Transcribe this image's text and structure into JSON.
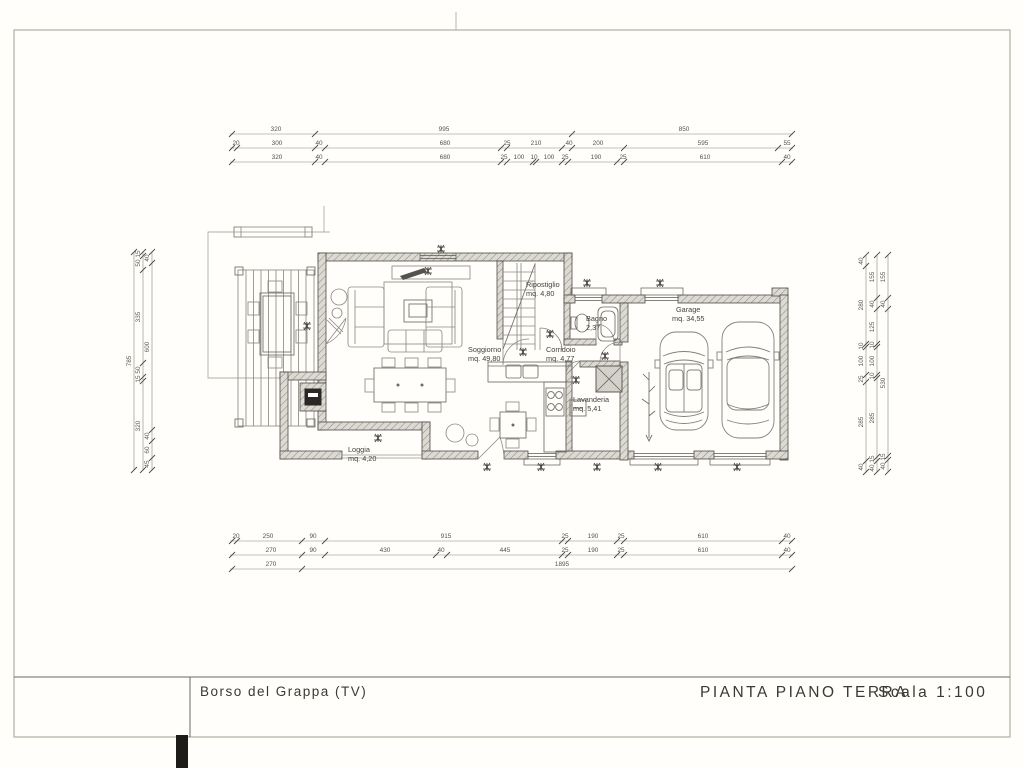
{
  "title_block": {
    "location": "Borso del Grappa (TV)",
    "drawing_title": "PIANTA PIANO TERRA",
    "scale": "Scala 1:100"
  },
  "rooms": [
    {
      "name": "Soggiorno",
      "area": "mq. 49,80"
    },
    {
      "name": "Ripostiglio",
      "area": "mq. 4,80"
    },
    {
      "name": "Bagno",
      "area": "2,37"
    },
    {
      "name": "Corridoio",
      "area": "mq. 4,77"
    },
    {
      "name": "Lavanderia",
      "area": "mq. 5,41"
    },
    {
      "name": "Garage",
      "area": "mq. 34,55"
    },
    {
      "name": "Loggia",
      "area": "mq. 4,20"
    }
  ],
  "dimensions": {
    "top_row1": [
      "320",
      "995",
      "850"
    ],
    "top_row2": [
      "20",
      "300",
      "40",
      "680",
      "25",
      "210",
      "40",
      "200",
      "595",
      "55"
    ],
    "top_row3": [
      "320",
      "40",
      "680",
      "25",
      "100",
      "10",
      "100",
      "25",
      "190",
      "25",
      "610",
      "40"
    ],
    "bottom_row1": [
      "20",
      "250",
      "90",
      "915",
      "25",
      "190",
      "25",
      "610",
      "40"
    ],
    "bottom_row2": [
      "270",
      "90",
      "430",
      "40",
      "445",
      "25",
      "190",
      "25",
      "610",
      "40"
    ],
    "bottom_row3": [
      "270",
      "1895"
    ],
    "left_total": [
      "785"
    ],
    "left_mid": [
      "15",
      "50",
      "335",
      "50",
      "15",
      "320"
    ],
    "left_inner": [
      "40",
      "600",
      "40",
      "60",
      "45"
    ],
    "right_inner": [
      "40",
      "280",
      "10",
      "100",
      "25",
      "285",
      "40"
    ],
    "right_mid": [
      "155",
      "40",
      "125",
      "10",
      "100",
      "10",
      "285",
      "15",
      "40"
    ],
    "right_outer": [
      "155",
      "40",
      "530",
      "15",
      "40"
    ]
  },
  "colors": {
    "paper": "#fffefb",
    "ink": "#4e4b45",
    "wall_hatch": "#c9c6c0"
  }
}
